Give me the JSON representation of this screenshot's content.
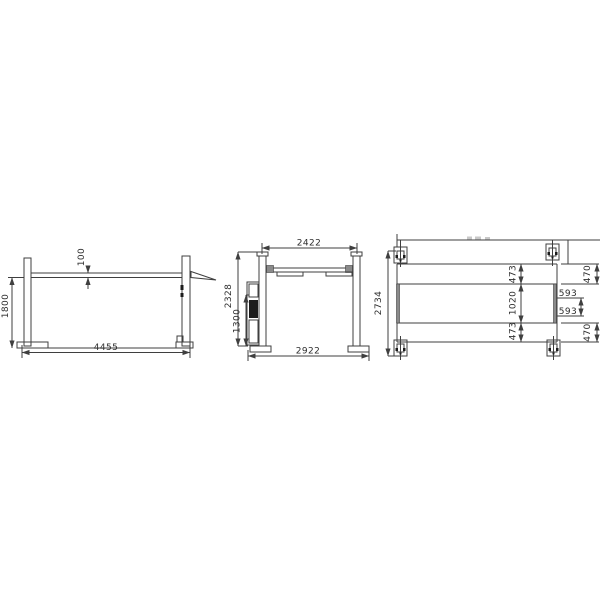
{
  "colors": {
    "background": "#ffffff",
    "line": "#3f3f3f",
    "text": "#2e2e2e",
    "dark_fill": "#1c1c1c"
  },
  "views": {
    "side": {
      "dims": {
        "lift_height": "1800",
        "runway_thickness": "100",
        "overall_length": "4455"
      }
    },
    "front": {
      "dims": {
        "inner_width": "2422",
        "column_height": "2328",
        "power_unit_height": "1300",
        "outer_width": "2922"
      }
    },
    "plan": {
      "dims": {
        "overall_depth": "2734",
        "runway_width_front": "473",
        "runway_gap": "1020",
        "runway_width_rear": "473",
        "edge_offset_front": "470",
        "center_offset_upper": "593",
        "center_offset_lower": "593",
        "edge_offset_rear": "470"
      }
    }
  }
}
